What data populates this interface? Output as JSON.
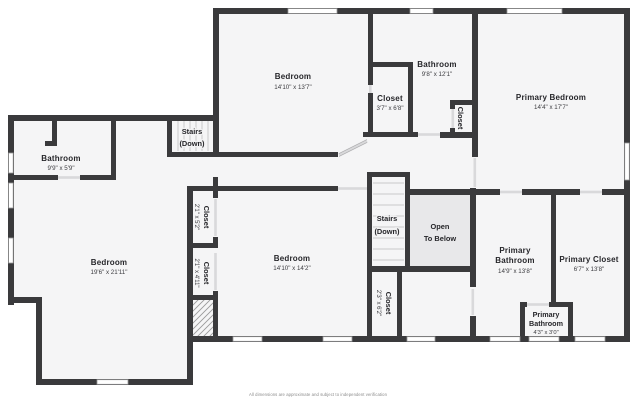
{
  "title": "Second floor plan",
  "palette": {
    "wall": "#3a3a3c",
    "floor": "#f5f5f6",
    "open_area": "#e8e8ea",
    "window": "#ffffff",
    "label_text": "#26262a",
    "footer_text": "#8a8a8a"
  },
  "rooms": {
    "bedroom_top": {
      "name": "Bedroom",
      "dims": "14'10\" x 13'7\""
    },
    "bathroom_top": {
      "name": "Bathroom",
      "dims": "9'8\" x 12'1\""
    },
    "closet_top": {
      "name": "Closet",
      "dims": "3'7\" x 6'8\""
    },
    "closet_upper_small": {
      "name": "Closet"
    },
    "primary_bedroom": {
      "name": "Primary Bedroom",
      "dims": "14'4\" x 17'7\""
    },
    "stairs_upper": {
      "line1": "Stairs",
      "line2": "(Down)"
    },
    "bathroom_left": {
      "name": "Bathroom",
      "dims": "9'9\" x 5'9\""
    },
    "closet_hall_a": {
      "name": "Closet",
      "dims": "2'1\" x 5'2\""
    },
    "closet_hall_b": {
      "name": "Closet",
      "dims": "2'1\" x 4'11\""
    },
    "bedroom_left": {
      "name": "Bedroom",
      "dims": "19'6\" x 21'11\""
    },
    "bedroom_mid": {
      "name": "Bedroom",
      "dims": "14'10\" x 14'2\""
    },
    "stairs_mid": {
      "line1": "Stairs",
      "line2": "(Down)"
    },
    "open_to_below": {
      "line1": "Open",
      "line2": "To Below"
    },
    "primary_bathroom": {
      "line1": "Primary",
      "line2": "Bathroom",
      "dims": "14'9\" x 13'8\""
    },
    "primary_closet": {
      "name": "Primary Closet",
      "dims": "6'7\" x 13'8\""
    },
    "primary_bath_small": {
      "line1": "Primary",
      "line2": "Bathroom",
      "dims": "4'3\" x 3'0\""
    },
    "closet_mid_low": {
      "name": "Closet",
      "dims": "2'3\" x 6'2\""
    }
  },
  "footer": {
    "disclaimer": "All dimensions are approximate and subject to independent verification"
  }
}
